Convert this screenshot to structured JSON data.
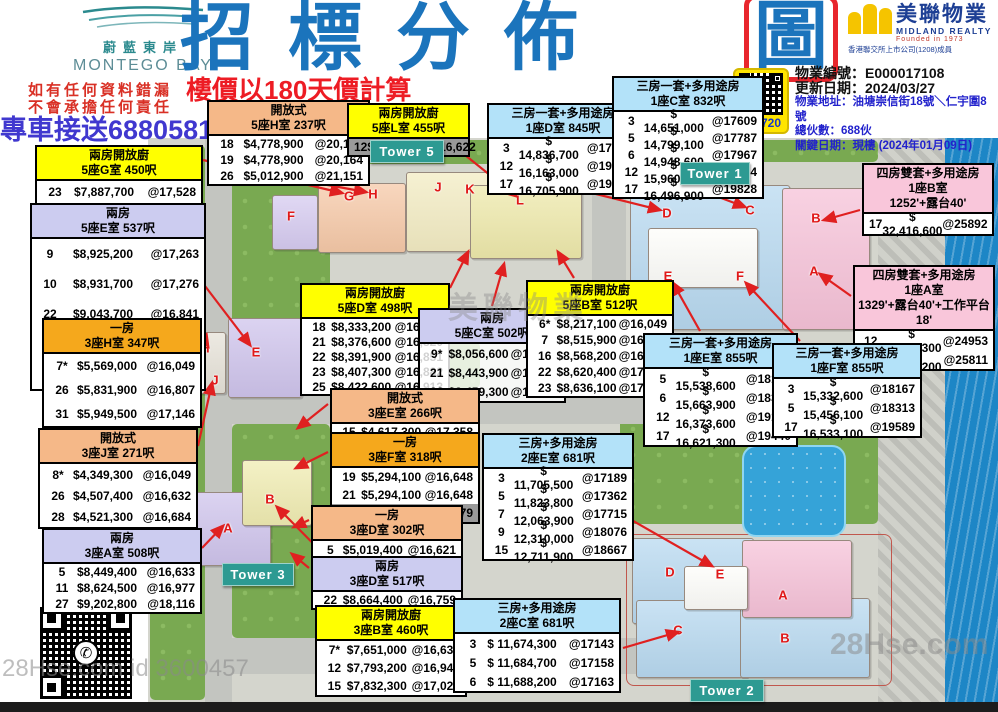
{
  "branding": {
    "montego": {
      "cn": "蔚藍東岸",
      "en": "MONTEGO BAY"
    },
    "midland": {
      "cn": "美聯物業",
      "en": "MIDLAND REALTY",
      "founded": "Founded in 1973",
      "member": "香港聯交所上市公司(1208)成員"
    }
  },
  "header": {
    "title_main": "招標分佈",
    "title_boxed": "圖",
    "subtitle": "樓價以180天價計算",
    "disclaimer1": "如有任何資料錯漏",
    "disclaimer2": "不會承擔任何責任",
    "phone": "專車接送68805811"
  },
  "info": {
    "property_id": "物業編號：E000017108",
    "updated": "更新日期：2024/03/27",
    "address": "物業地址：油塘崇信街18號＼仁宇圍8號",
    "units": "總伙數：688伙",
    "key_date": "關鍵日期：現樓 (2024年01月09日)"
  },
  "vr_badge": "VR 720",
  "whatsapp_caption": "WhatsApp 聯絡人",
  "watermarks": {
    "midland": "美聯物業",
    "hse": "28Hse.com",
    "hse_id": "28Hse.com id 3600457"
  },
  "map": {
    "towers": [
      "Tower 5",
      "Tower 1",
      "Tower 3",
      "Tower 2"
    ],
    "letters": [
      "F",
      "G",
      "H",
      "J",
      "K",
      "L",
      "E",
      "H",
      "J",
      "A",
      "B",
      "D",
      "C",
      "B",
      "E",
      "F",
      "A",
      "D",
      "E",
      "C",
      "B",
      "A"
    ]
  },
  "tables": [
    {
      "type": "兩房開放廚",
      "unit": "5座G室 450呎",
      "color": "yellow",
      "rows": [
        [
          "23",
          "$7,887,700",
          "@17,528"
        ],
        [
          "27",
          "$8,078,500",
          "@17,952"
        ]
      ]
    },
    {
      "type": "兩房",
      "unit": "5座E室 537呎",
      "color": "lavender",
      "rows": [
        [
          "9",
          "$8,925,200",
          "@17,263"
        ],
        [
          "10",
          "$8,931,700",
          "@17,276"
        ],
        [
          "22",
          "$9,043,700",
          "@16,841"
        ],
        [
          "23",
          "$9,116,000",
          "@16,976"
        ],
        [
          "25",
          "$9,188,900",
          "@17,112"
        ]
      ]
    },
    {
      "type": "一房",
      "unit": "3座H室 347呎",
      "color": "amber",
      "rows": [
        [
          "7*",
          "$5,569,000",
          "@16,049"
        ],
        [
          "26",
          "$5,831,900",
          "@16,807"
        ],
        [
          "31",
          "$5,949,500",
          "@17,146"
        ]
      ]
    },
    {
      "type": "開放式",
      "unit": "3座J室 271呎",
      "color": "peach",
      "rows": [
        [
          "8*",
          "$4,349,300",
          "@16,049"
        ],
        [
          "26",
          "$4,507,400",
          "@16,632"
        ],
        [
          "28",
          "$4,521,300",
          "@16,684"
        ]
      ]
    },
    {
      "type": "兩房",
      "unit": "3座A室 508呎",
      "color": "lavender",
      "rows": [
        [
          "5",
          "$8,449,400",
          "@16,633"
        ],
        [
          "11",
          "$8,624,500",
          "@16,977"
        ],
        [
          "27",
          "$9,202,800",
          "@18,116"
        ]
      ]
    },
    {
      "type": "開放式",
      "unit": "5座H室 237呎",
      "color": "peach",
      "rows": [
        [
          "18",
          "$4,778,900",
          "@20,164"
        ],
        [
          "19",
          "$4,778,900",
          "@20,164"
        ],
        [
          "26",
          "$5,012,900",
          "@21,151"
        ]
      ]
    },
    {
      "type": "兩房開放廚",
      "unit": "5座L室 455呎",
      "color": "yellow",
      "hl": [
        0
      ],
      "rows": [
        [
          "12",
          "$7,563,100",
          "@16,622"
        ]
      ]
    },
    {
      "type": "三房一套+多用途房",
      "unit": "1座D室 845呎",
      "color": "blue",
      "rows": [
        [
          "3",
          "$ 14,836,700",
          "@17558"
        ],
        [
          "12",
          "$ 16,163,000",
          "@19128"
        ],
        [
          "17",
          "$ 16,705,900",
          "@19770"
        ]
      ]
    },
    {
      "type": "三房一套+多用途房",
      "unit": "1座C室 832呎",
      "color": "blue",
      "rows": [
        [
          "3",
          "$ 14,651,000",
          "@17609"
        ],
        [
          "5",
          "$ 14,799,100",
          "@17787"
        ],
        [
          "6",
          "$ 14,948,600",
          "@17967"
        ],
        [
          "12",
          "$ 15,960,700",
          "@19184"
        ],
        [
          "17",
          "$ 16,496,900",
          "@19828"
        ]
      ]
    },
    {
      "type": "四房雙套+多用途房",
      "unit": "1座B室",
      "unit2": "1252'+露台40'",
      "color": "pink",
      "rows": [
        [
          "17",
          "$ 32,416,600",
          "@25892"
        ]
      ]
    },
    {
      "type": "四房雙套+多用途房",
      "unit": "1座A室",
      "unit2": "1329'+露台40'+工作平台18'",
      "color": "pink",
      "rows": [
        [
          "12",
          "$ 33,162,300",
          "@24953"
        ],
        [
          "17",
          "$ 34,303,200",
          "@25811"
        ]
      ]
    },
    {
      "type": "兩房開放廚",
      "unit": "5座D室 498呎",
      "color": "yellow",
      "rows": [
        [
          "18",
          "$8,333,200",
          "@16,733"
        ],
        [
          "21",
          "$8,376,600",
          "@16,820"
        ],
        [
          "22",
          "$8,391,900",
          "@16,851"
        ],
        [
          "23",
          "$8,407,300",
          "@16,882"
        ],
        [
          "25",
          "$8,422,600",
          "@16,913"
        ]
      ]
    },
    {
      "type": "兩房",
      "unit": "5座C室 502呎",
      "color": "lavender",
      "translucent": true,
      "rows": [
        [
          "9*",
          "$8,056,600",
          "@16,049"
        ],
        [
          "21",
          "$8,443,900",
          "@16,821"
        ],
        [
          "22",
          "$8,459,300",
          "@16,851"
        ]
      ]
    },
    {
      "type": "兩房開放廚",
      "unit": "5座B室 512呎",
      "color": "yellow",
      "rows": [
        [
          "6*",
          "$8,217,100",
          "@16,049"
        ],
        [
          "7",
          "$8,515,900",
          "@16,633"
        ],
        [
          "16",
          "$8,568,200",
          "@16,735"
        ],
        [
          "22",
          "$8,620,400",
          "@17,310"
        ],
        [
          "23",
          "$8,636,100",
          "@17,342"
        ]
      ]
    },
    {
      "type": "開放式",
      "unit": "3座E室 266呎",
      "color": "peach",
      "rows": [
        [
          "15",
          "$4,617,300",
          "@17,358"
        ]
      ]
    },
    {
      "type": "一房",
      "unit": "3座F室 318呎",
      "color": "amber",
      "hl": [
        2
      ],
      "rows": [
        [
          "19",
          "$5,294,100",
          "@16,648"
        ],
        [
          "21",
          "$5,294,100",
          "@16,648"
        ],
        [
          "25",
          "$5,303,800",
          "@16,679"
        ]
      ]
    },
    {
      "type": "一房",
      "unit": "3座D室 302呎",
      "color": "peach",
      "rows": [
        [
          "5",
          "$5,019,400",
          "@16,621"
        ]
      ]
    },
    {
      "type": "兩房",
      "unit": "3座D室 517呎",
      "color": "lavender",
      "rows": [
        [
          "22",
          "$8,664,400",
          "@16,759"
        ]
      ]
    },
    {
      "type": "兩房開放廚",
      "unit": "3座B室 460呎",
      "color": "yellow",
      "rows": [
        [
          "7*",
          "$7,651,000",
          "@16,633"
        ],
        [
          "12",
          "$7,793,200",
          "@16,942"
        ],
        [
          "15",
          "$7,832,300",
          "@17,027"
        ]
      ]
    },
    {
      "type": "三房+多用途房",
      "unit": "2座E室 681呎",
      "color": "blue",
      "rows": [
        [
          "3",
          "$ 11,705,500",
          "@17189"
        ],
        [
          "5",
          "$ 11,823,800",
          "@17362"
        ],
        [
          "7",
          "$ 12,063,900",
          "@17715"
        ],
        [
          "9",
          "$ 12,310,000",
          "@18076"
        ],
        [
          "15",
          "$ 12,711,900",
          "@18667"
        ]
      ]
    },
    {
      "type": "三房+多用途房",
      "unit": "2座C室 681呎",
      "color": "blue",
      "rows": [
        [
          "3",
          "$ 11,674,300",
          "@17143"
        ],
        [
          "5",
          "$ 11,684,700",
          "@17158"
        ],
        [
          "6",
          "$ 11,688,200",
          "@17163"
        ]
      ]
    },
    {
      "type": "三房一套+多用途房",
      "unit": "1座E室 855呎",
      "color": "blue",
      "rows": [
        [
          "5",
          "$ 15,538,600",
          "@18174"
        ],
        [
          "6",
          "$ 15,663,900",
          "@18320"
        ],
        [
          "12",
          "$ 16,373,600",
          "@19150"
        ],
        [
          "17",
          "$ 16,621,300",
          "@19440"
        ]
      ]
    },
    {
      "type": "三房一套+多用途房",
      "unit": "1座F室 855呎",
      "color": "blue",
      "rows": [
        [
          "3",
          "$ 15,332,600",
          "@18167"
        ],
        [
          "5",
          "$ 15,456,100",
          "@18313"
        ],
        [
          "17",
          "$ 16,533,100",
          "@19589"
        ]
      ]
    }
  ]
}
